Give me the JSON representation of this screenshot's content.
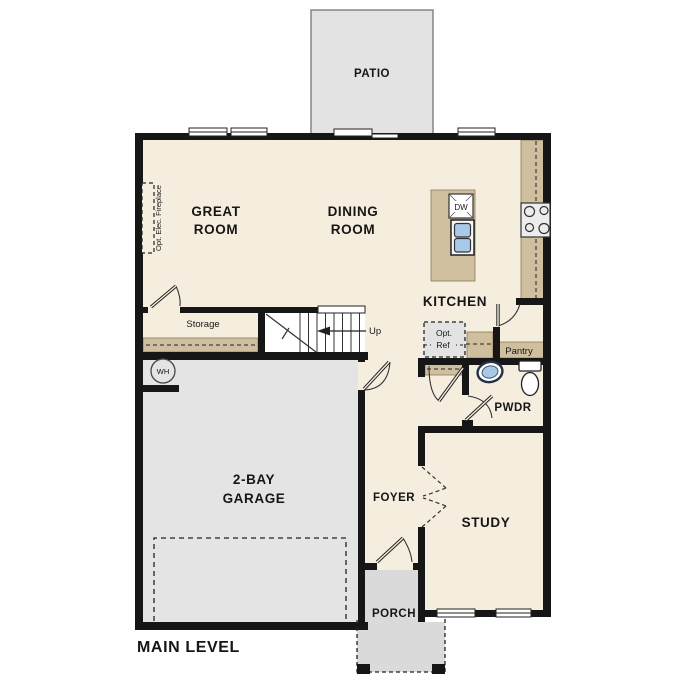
{
  "plan_title": "MAIN LEVEL",
  "rooms": {
    "patio": "PATIO",
    "great_room_line1": "GREAT",
    "great_room_line2": "ROOM",
    "dining_line1": "DINING",
    "dining_line2": "ROOM",
    "kitchen": "KITCHEN",
    "garage_line1": "2-BAY",
    "garage_line2": "GARAGE",
    "foyer": "FOYER",
    "study": "STUDY",
    "porch": "PORCH",
    "pwdr": "PWDR",
    "storage": "Storage",
    "pantry": "Pantry"
  },
  "annotations": {
    "stairs_direction": "Up",
    "fireplace": "Opt. Elec. Fireplace",
    "water_heater": "WH",
    "dishwasher": "DW",
    "opt_ref_line1": "Opt.",
    "opt_ref_line2": "Ref"
  },
  "colors": {
    "floor": "#f5eedf",
    "counter_tan": "#cfbf9f",
    "garage_gray": "#e4e4e4",
    "patio_gray": "#e3e3e3",
    "porch_gray": "#dadada",
    "wall_black": "#161616",
    "sink_blue": "#a9c9e9",
    "appliance_gray": "#ececec"
  }
}
